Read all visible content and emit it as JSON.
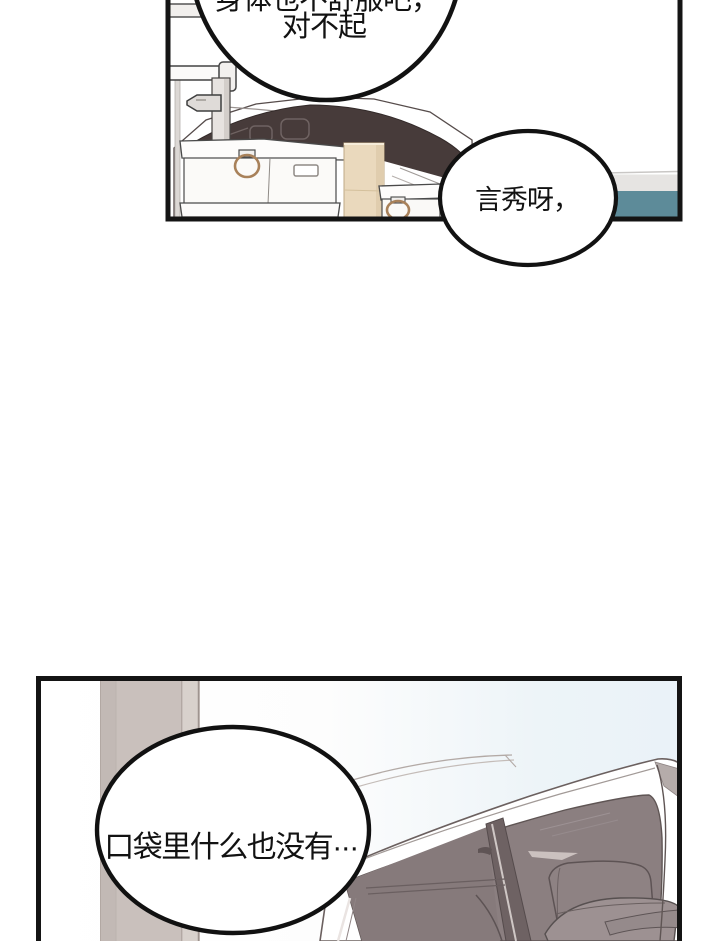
{
  "comic": {
    "page_background": "#ffffff",
    "panel_border_color": "#141414",
    "top_panel": {
      "scene": "car-trunk-with-storage-boxes",
      "bubble_main": {
        "line1": "身体也不舒服吧，",
        "line1_note": "top half cut off by page edge",
        "line2": "对不起"
      },
      "bubble_side": {
        "text": "言秀呀，"
      },
      "colors": {
        "car_window": "#473b3a",
        "teal_stripe": "#5d8b99",
        "gray_stripe": "#e6e4e2",
        "tan_box": "#ead9bd",
        "brass_ring": "#a8815a",
        "white_box": "#fbfaf8"
      }
    },
    "bottom_panel": {
      "scene": "white-car-open-door-interior",
      "bubble": {
        "text": "口袋里什么也没有···"
      },
      "colors": {
        "sky": "#eaf2f8",
        "pillar": "#c9c0bc",
        "car_interior": "#8b7f80",
        "door_pillar_dark": "#6e6263",
        "seat": "#9d9192",
        "headrest": "#8e8283",
        "car_body": "#ffffff"
      }
    }
  }
}
